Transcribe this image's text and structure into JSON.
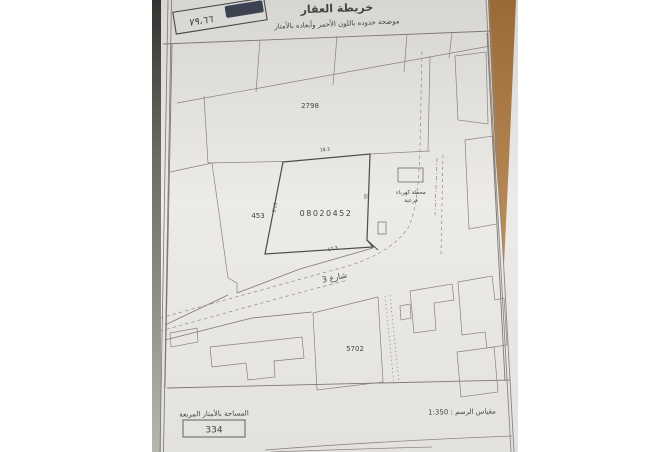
{
  "photo": {
    "title": "خريطة العقار",
    "subtitle": "موضحة حدوده باللون الأحمر وأبعاده بالأمتار",
    "stamp": {
      "label": "رقم الوثيقة",
      "number": "٧٩،٦٦"
    },
    "map": {
      "parcel_top": "2798",
      "parcel_left": "453",
      "parcel_subject": "08020452",
      "parcel_bottom": "5702",
      "substation_line1": "محطة كهرباء",
      "substation_line2": "فرعية",
      "street": "شارع 3",
      "dim_top": "18.3",
      "dim_left": "17.3",
      "dim_right": "35",
      "dim_bottom": "17.3"
    },
    "footer": {
      "area_label": "المساحة بالأمتار المربعة",
      "area_value": "334",
      "scale_label": "مقياس الرسم : 1:350"
    }
  },
  "colors": {
    "paper": "#e9e7e3",
    "table_brown": "#a87a46",
    "handwriting_ink": "#32395c",
    "map_line": "#7d7a76"
  }
}
